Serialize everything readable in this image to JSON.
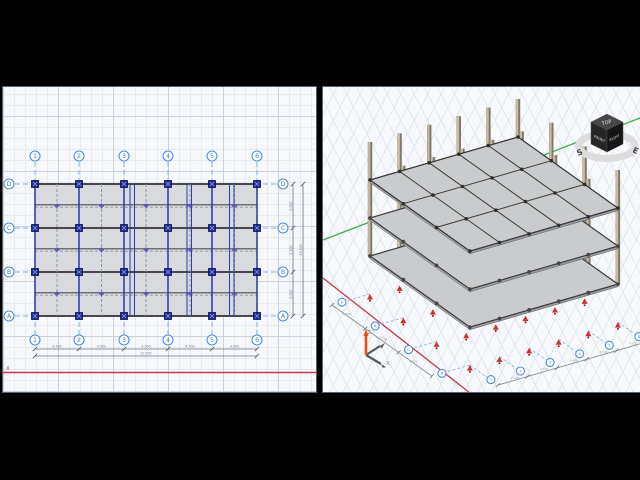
{
  "window": {
    "background": "#000000"
  },
  "left_view": {
    "grid_numbers": [
      "1",
      "2",
      "3",
      "4",
      "5",
      "6"
    ],
    "grid_letters_top_to_bottom": [
      "D",
      "C",
      "B",
      "A"
    ],
    "bay_dims_horizontal": [
      "4.500",
      "4.500",
      "4.500",
      "4.500",
      "4.500"
    ],
    "total_dim_horizontal": "22.500",
    "bay_dims_vertical": [
      "4.500",
      "4.500",
      "4.500"
    ],
    "total_dim_vertical": "13.500",
    "axis_label": "X"
  },
  "right_view": {
    "triad": {
      "x_label": "X",
      "y_label": "Y",
      "z_label": "Z"
    },
    "view_cube": {
      "top_face": "TOP",
      "front_face": "FRONT",
      "right_face": "RIGHT",
      "compass_letters": [
        "S",
        "E"
      ]
    },
    "structure": {
      "stories": 3,
      "bays_long": 5,
      "bays_short": 3
    }
  },
  "colors": {
    "grid_bubble_blue": "#4a90d9",
    "grid_bubble_text": "#3a7bc8",
    "grid_line_blue": "#7fb2e8",
    "column_marker_navy": "#1d2b9e",
    "axis_x_red": "#c23b4e",
    "axis_y_green": "#3fae4e",
    "beam_dark": "#46464c",
    "slab_plan_gray": "#d9dadd",
    "slab_3d_gray": "#c9cbcd",
    "column_tan": "#c8bca4",
    "column_tan_dark": "#80776a",
    "support_red": "#cf2f2f",
    "dim_gray": "#6c727c"
  }
}
